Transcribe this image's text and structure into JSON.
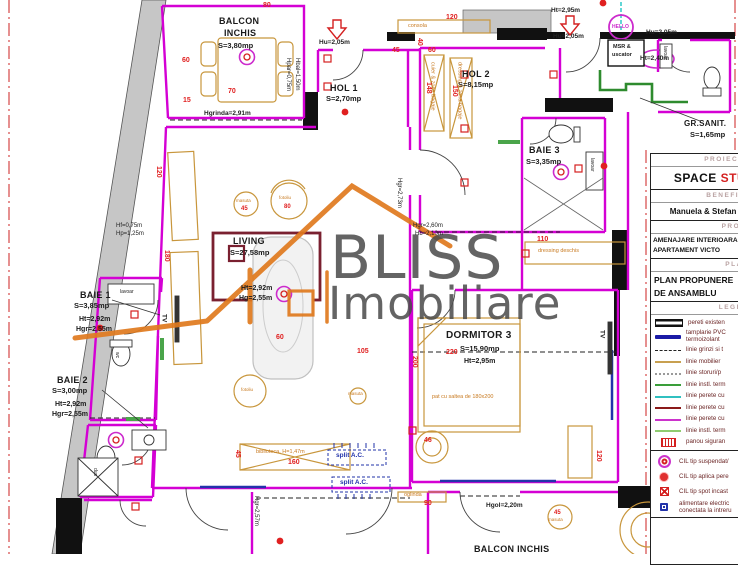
{
  "watermark": {
    "line1": "BLISS",
    "line2": "Imobiliare"
  },
  "rooms": {
    "balcon_top": {
      "n1": "BALCON",
      "n2": "INCHIS",
      "area": "S=3,80mp"
    },
    "hol1": {
      "name": "HOL 1",
      "area": "S=2,70mp"
    },
    "hol2": {
      "name": "HOL 2",
      "area": "S=8,15mp"
    },
    "baie3": {
      "name": "BAIE 3",
      "area": "S=3,35mp"
    },
    "grsanit": {
      "name": "GR.SANIT.",
      "area": "S=1,65mp"
    },
    "baie1": {
      "name": "BAIE 1",
      "area": "S=3,85mp",
      "ht": "Ht=2,92m",
      "hgr": "Hgr=2,55m"
    },
    "baie2": {
      "name": "BAIE 2",
      "area": "S=3,00mp",
      "ht": "Ht=2,92m",
      "hgr": "Hgr=2,55m"
    },
    "living": {
      "name": "LIVING",
      "area": "S=27,58mp",
      "ht": "Ht=2,92m",
      "hgr": "Hg=2,55m"
    },
    "dormitor3": {
      "name": "DORMITOR 3",
      "area": "S=15,90mp",
      "ht": "Ht=2,95m"
    },
    "balcon_bottom": {
      "name": "BALCON INCHIS"
    }
  },
  "dims": [
    "80",
    "120",
    "40",
    "45",
    "60",
    "148",
    "150",
    "60",
    "70",
    "15",
    "110",
    "105",
    "220",
    "200",
    "160",
    "45",
    "90",
    "120",
    "46",
    "120",
    "180",
    "60"
  ],
  "ann": [
    "Ht=2,95m",
    "Hu=2,05m",
    "Hu=2,05m",
    "Hu=2,05m",
    "Ht=2,40m",
    "Hgrinda=2,91m",
    "Hpar=0,75m",
    "Hbal=1,50m",
    "Hgr=2,73m",
    "Hgr=2,60m",
    "Hb=2,10m",
    "Hf=0,75m",
    "Hp=1,25m",
    "Hgol=2,20m",
    "Hgr=2,57m",
    "split A.C.",
    "split A.C.",
    "oglinda",
    "consola",
    "HELLO",
    "MSR &",
    "uscator",
    "dressing deschis",
    "pat cu saltea de 180x200",
    "biblioteca, H=1,47m",
    "cuier & zona bagaje",
    "dressing & zona bagaje",
    "TV",
    "TV",
    "lavoar",
    "lavoar",
    "lavoar",
    "dus",
    "wc",
    "masuta",
    "45",
    "fotoliu",
    "80",
    "fotoliu",
    "masuta",
    "45",
    "masuta"
  ],
  "titleblock": {
    "h1": "PROIECTANT",
    "v1_black": "SPACE ",
    "v1_red": "STU",
    "h2": "BENEFICIAR",
    "v2": "Manuela & Stefan Mo",
    "h3": "PROIECT",
    "v3_line1": "AMENAJARE INTERIOARA",
    "v3_line2": "APARTAMENT VICTO",
    "h4": "PLANSA",
    "v4_line1": "PLAN PROPUNERE",
    "v4_line2": "DE ANSAMBLU",
    "h5": "LEGENDA"
  },
  "legend": {
    "items": [
      {
        "label": "pereti existen"
      },
      {
        "label": "tamplarie PVC",
        "label2": "termoizolant"
      },
      {
        "label": "linie grinzi si t"
      },
      {
        "label": "linie mobilier"
      },
      {
        "label": "linie storuri/p"
      },
      {
        "label": "linie instl. term"
      },
      {
        "label": "linie perete cu"
      },
      {
        "label": "linie perete cu"
      },
      {
        "label": "linie perete cu"
      },
      {
        "label": "linie instl. term"
      },
      {
        "label": "panou siguran"
      }
    ],
    "cil_items": [
      {
        "label": "CIL tip suspendat/"
      },
      {
        "label": "CIL tip aplica pere"
      },
      {
        "label": "CIL tip spot incast"
      },
      {
        "label": "alimentare electric",
        "label2": "conectata la intreru"
      }
    ]
  },
  "colors": {
    "wall_new": "#d400d4",
    "wall_existing": "#111111",
    "dim_red": "#e02020",
    "furniture_tan": "#c8963c",
    "logo_orange": "#e07a1e",
    "pipe_green": "#2e8b2e",
    "window_blue": "#2233aa",
    "rug_darkred": "#7a2030",
    "watermark_gray": "#4a4a4a"
  }
}
